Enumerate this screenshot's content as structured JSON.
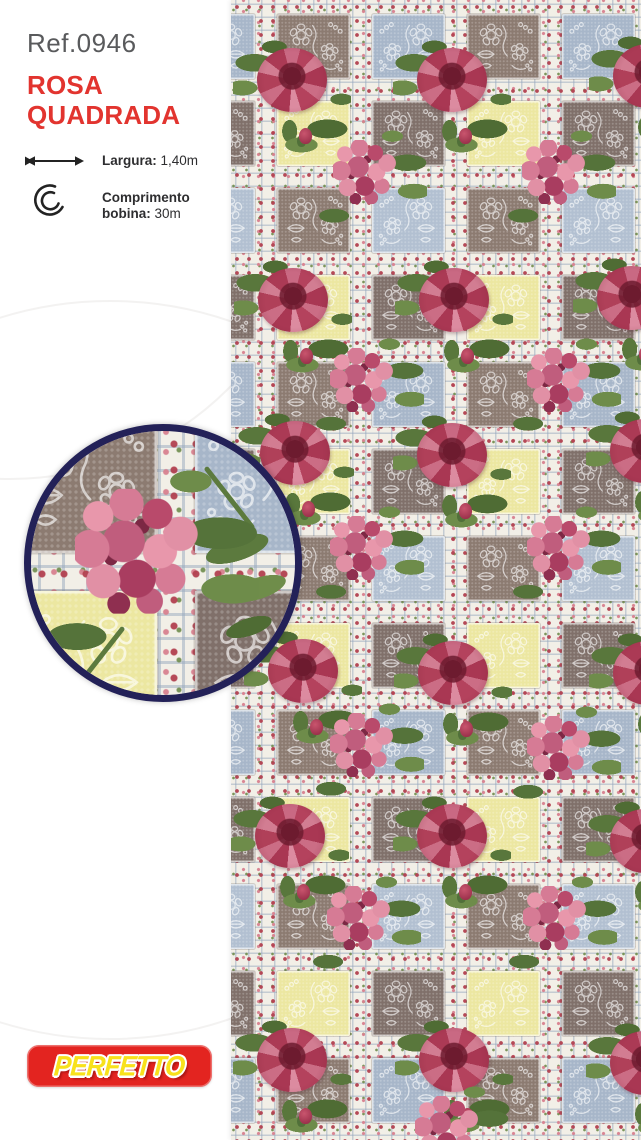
{
  "product": {
    "ref": "Ref.0946",
    "name_line1": "ROSA",
    "name_line2": "QUADRADA",
    "specs": [
      {
        "icon": "width-arrow-icon",
        "label": "Largura:",
        "value": "1,40m"
      },
      {
        "icon": "roll-icon",
        "label_line1": "Comprimento",
        "label_line2": "bobina:",
        "value": "30m"
      }
    ]
  },
  "brand": {
    "logo_text": "PERFETTO"
  },
  "colors": {
    "title_red": "#e2342f",
    "ref_gray": "#595a5c",
    "logo_red": "#e32420",
    "logo_yellow": "#f8e11c",
    "detail_ring_navy": "#232158"
  },
  "fabric": {
    "description": "Patchwork fabric: steel-blue, taupe-brown and pale-yellow squares with white lace flower outlines, cream sashing with rosebud garland and ribbon, large pink roses and pink hydrangea clusters",
    "palette": {
      "blue": "#a7b6c9",
      "blue_light": "#b2c0d1",
      "brown": "#8c7b71",
      "brown_dark": "#80706a",
      "yellow": "#ece7a1",
      "sash": "#f2efe7"
    },
    "roses": [
      [
        292,
        97
      ],
      [
        452,
        97
      ],
      [
        648,
        93
      ],
      [
        293,
        317
      ],
      [
        454,
        317
      ],
      [
        632,
        315
      ],
      [
        295,
        470
      ],
      [
        452,
        472
      ],
      [
        645,
        468
      ],
      [
        303,
        688
      ],
      [
        453,
        690
      ],
      [
        648,
        690
      ],
      [
        290,
        853
      ],
      [
        452,
        853
      ],
      [
        645,
        858
      ],
      [
        292,
        1077
      ],
      [
        454,
        1077
      ],
      [
        645,
        1080
      ]
    ],
    "hydrangeas": [
      [
        373,
        177
      ],
      [
        562,
        177
      ],
      [
        370,
        385
      ],
      [
        567,
        385
      ],
      [
        370,
        553
      ],
      [
        567,
        553
      ],
      [
        370,
        750
      ],
      [
        567,
        753
      ],
      [
        367,
        923
      ],
      [
        563,
        923
      ],
      [
        455,
        1133
      ]
    ]
  }
}
